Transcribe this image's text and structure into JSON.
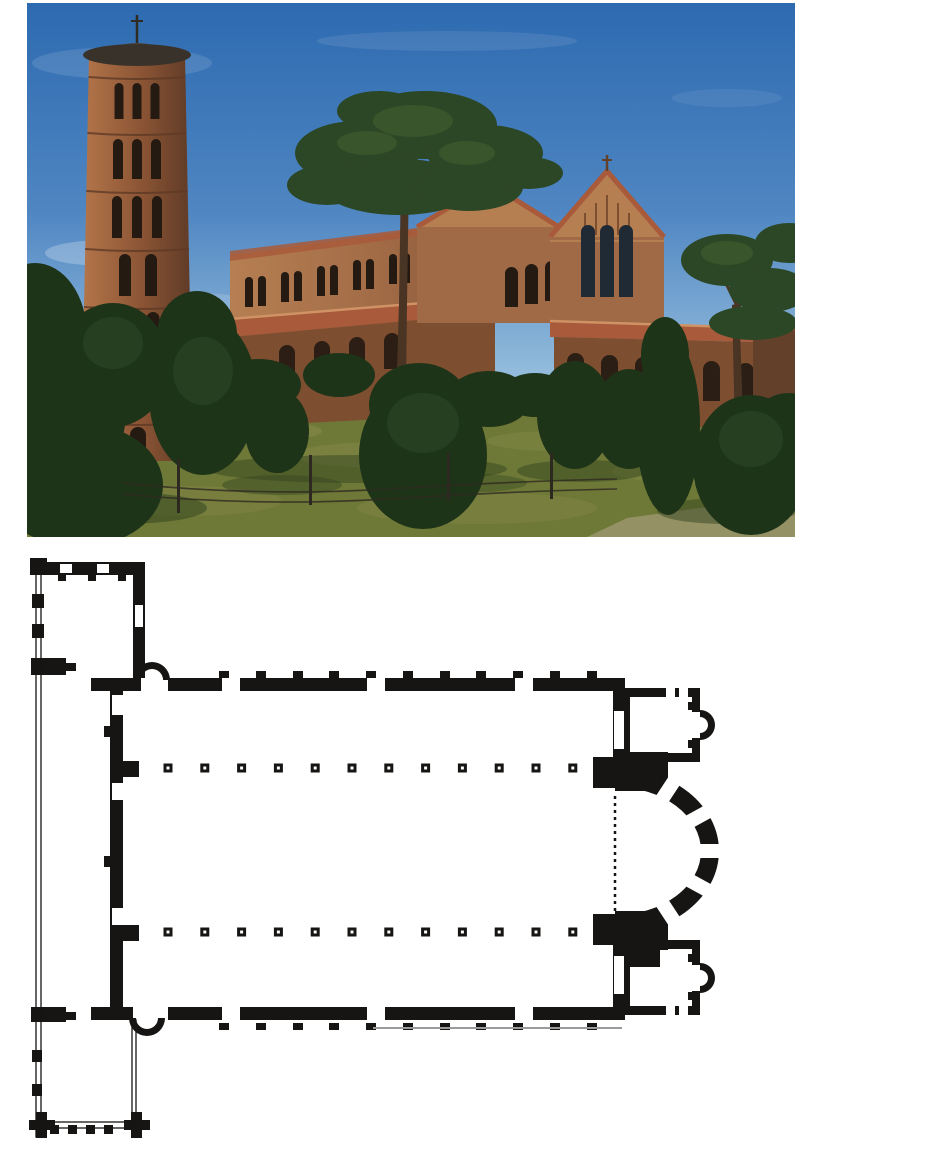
{
  "figure": {
    "photo_label": "Exterior photograph: brick basilica with round campanile among pines",
    "plan_label": "Floor plan: narthex with corner rooms, nave with twin colonnades of 12 columns, apse flanked by two chapels with small apses"
  },
  "palette": {
    "paper": "#ffffff",
    "ink": "#171513",
    "sky_top": "#2d6ab0",
    "sky_mid": "#4f86c2",
    "sky_low": "#96bedd",
    "cloud": "#e8f0f7",
    "grass": "#6e7837",
    "grass_light": "#8d8f4e",
    "grass_dark": "#33451f",
    "path": "#98946a",
    "brick": "#a06a46",
    "brick_lit": "#b67f52",
    "brick_shade": "#7e4e31",
    "brick_dark": "#63402a",
    "roof": "#a85a3a",
    "roof_lit": "#cf9264",
    "opening": "#241a12",
    "glass": "#202a35",
    "tower_lit": "#b5764a",
    "tower_mid": "#8a5434",
    "tower_shade": "#5e3a26",
    "cap": "#38322a",
    "tree": "#2c4726",
    "tree_light": "#46632f",
    "tree_dark": "#1e3418",
    "trunk": "#4a3424",
    "wall_white": "#e3dfd0",
    "fence": "#2e2920"
  },
  "photo": {
    "clouds": [
      [
        95,
        60,
        90,
        16,
        0.13
      ],
      [
        420,
        38,
        130,
        10,
        0.1
      ],
      [
        80,
        250,
        62,
        13,
        0.28
      ],
      [
        160,
        300,
        70,
        10,
        0.18
      ],
      [
        700,
        95,
        55,
        9,
        0.08
      ]
    ],
    "grass_patches": [
      [
        210,
        428,
        85,
        12,
        0.45
      ],
      [
        360,
        452,
        95,
        13,
        0.4
      ],
      [
        530,
        438,
        70,
        10,
        0.35
      ],
      [
        660,
        468,
        75,
        12,
        0.35
      ],
      [
        160,
        498,
        95,
        15,
        0.3
      ],
      [
        450,
        505,
        120,
        16,
        0.3
      ]
    ],
    "grass_shadows": [
      [
        330,
        466,
        150,
        14,
        0.5
      ],
      [
        95,
        505,
        85,
        16,
        0.55
      ],
      [
        555,
        468,
        65,
        11,
        0.5
      ],
      [
        700,
        508,
        70,
        13,
        0.5
      ],
      [
        255,
        482,
        60,
        10,
        0.45
      ],
      [
        430,
        480,
        70,
        10,
        0.4
      ]
    ],
    "tower": {
      "belts": [
        74,
        130,
        188,
        246,
        304,
        362,
        420
      ],
      "tiers": [
        {
          "y": 80,
          "h": 36,
          "w": 9,
          "xs": [
            92,
            110,
            128
          ]
        },
        {
          "y": 136,
          "h": 40,
          "w": 10,
          "xs": [
            91,
            110,
            129
          ]
        },
        {
          "y": 193,
          "h": 42,
          "w": 10,
          "xs": [
            90,
            110,
            130
          ]
        },
        {
          "y": 251,
          "h": 42,
          "w": 12,
          "xs": [
            98,
            124
          ]
        },
        {
          "y": 309,
          "h": 44,
          "w": 13,
          "xs": [
            96,
            126
          ]
        },
        {
          "y": 367,
          "h": 44,
          "w": 16,
          "xs": [
            111
          ]
        },
        {
          "y": 424,
          "h": 28,
          "w": 16,
          "xs": [
            111
          ]
        }
      ]
    },
    "flank_windows": [
      [
        218,
        274
      ],
      [
        254,
        269
      ],
      [
        290,
        263
      ],
      [
        326,
        257
      ],
      [
        362,
        251
      ],
      [
        398,
        246
      ]
    ],
    "flank_window": {
      "w": 8,
      "h": 30,
      "gap": 13
    },
    "flank_arcade": [
      [
        252,
        342
      ],
      [
        287,
        338
      ],
      [
        322,
        334
      ],
      [
        357,
        330
      ]
    ],
    "midblock_windows": [
      [
        478,
        264
      ],
      [
        498,
        261
      ],
      [
        518,
        258
      ]
    ],
    "facade_windows": [
      [
        554,
        222
      ],
      [
        573,
        222
      ],
      [
        592,
        222
      ]
    ],
    "gable_strips": [
      [
        558,
        210
      ],
      [
        569,
        200
      ],
      [
        580,
        192
      ],
      [
        591,
        200
      ],
      [
        602,
        210
      ]
    ],
    "porch_arches": [
      [
        540,
        350
      ],
      [
        574,
        352
      ],
      [
        608,
        354
      ],
      [
        642,
        356
      ],
      [
        676,
        358
      ],
      [
        710,
        360
      ]
    ],
    "wall_posts": [
      112,
      147,
      182,
      217,
      252,
      287,
      322,
      357,
      392
    ],
    "fence_posts": [
      [
        150,
        456,
        54
      ],
      [
        282,
        452,
        50
      ],
      [
        420,
        450,
        48
      ],
      [
        523,
        450,
        46
      ]
    ],
    "fence_wires": [
      "M95,480 Q230,494 360,486 T590,476",
      "M95,491 Q230,504 360,496 T590,486"
    ],
    "pines": [
      [
        330,
        150,
        62,
        32
      ],
      [
        398,
        122,
        72,
        34
      ],
      [
        458,
        150,
        58,
        28
      ],
      [
        372,
        184,
        76,
        28
      ],
      [
        442,
        184,
        54,
        24
      ],
      [
        300,
        182,
        40,
        20
      ],
      [
        502,
        170,
        34,
        16
      ],
      [
        352,
        108,
        42,
        20
      ],
      [
        700,
        257,
        46,
        26
      ],
      [
        742,
        287,
        40,
        22
      ],
      [
        762,
        240,
        34,
        20
      ],
      [
        726,
        320,
        44,
        17
      ]
    ],
    "pine_highlights": [
      [
        386,
        118,
        40,
        16
      ],
      [
        340,
        140,
        30,
        12
      ],
      [
        440,
        150,
        28,
        12
      ],
      [
        700,
        250,
        26,
        12
      ]
    ],
    "bushes": [
      [
        28,
        400,
        72,
        98
      ],
      [
        86,
        362,
        56,
        62
      ],
      [
        52,
        482,
        84,
        62
      ],
      [
        8,
        332,
        52,
        72
      ],
      [
        176,
        392,
        54,
        80
      ],
      [
        170,
        332,
        40,
        44
      ],
      [
        250,
        428,
        32,
        42
      ],
      [
        396,
        452,
        64,
        74
      ],
      [
        392,
        402,
        50,
        42
      ],
      [
        548,
        412,
        38,
        54
      ],
      [
        602,
        416,
        36,
        50
      ],
      [
        641,
        422,
        32,
        90
      ],
      [
        638,
        352,
        24,
        38
      ],
      [
        724,
        462,
        58,
        70
      ],
      [
        762,
        432,
        42,
        42
      ],
      [
        462,
        396,
        42,
        28
      ],
      [
        508,
        392,
        34,
        22
      ],
      [
        312,
        372,
        36,
        22
      ],
      [
        232,
        382,
        42,
        26
      ]
    ],
    "bush_highlights": [
      [
        176,
        368,
        30,
        34
      ],
      [
        396,
        420,
        36,
        30
      ],
      [
        86,
        340,
        30,
        26
      ],
      [
        724,
        436,
        32,
        28
      ]
    ],
    "trunks": [
      "M367,470 L372,300 374,172 382,172 380,300 378,470 Z",
      "M709,470 L705,302 712,300 718,468 Z",
      "M249,470 L251,400 255,400 256,470 Z"
    ],
    "branches": [
      "M376,178 L344,132",
      "M376,178 L404,128",
      "M377,184 L432,152",
      "M377,184 L322,160",
      "M711,305 L690,262",
      "M711,305 L736,268"
    ]
  },
  "plan": {
    "black_rects": [
      [
        7,
        6,
        110,
        13
      ],
      [
        105,
        6,
        12,
        129
      ],
      [
        2,
        2,
        17,
        17
      ],
      [
        4,
        38,
        12,
        14
      ],
      [
        4,
        68,
        12,
        14
      ],
      [
        30,
        19,
        8,
        6
      ],
      [
        60,
        19,
        8,
        6
      ],
      [
        90,
        19,
        8,
        6
      ],
      [
        3,
        102,
        35,
        17
      ],
      [
        38,
        107,
        10,
        8
      ],
      [
        63,
        122,
        42,
        13
      ],
      [
        140,
        122,
        457,
        13
      ],
      [
        191,
        115,
        10,
        7
      ],
      [
        228,
        115,
        10,
        7
      ],
      [
        265,
        115,
        10,
        7
      ],
      [
        301,
        115,
        10,
        7
      ],
      [
        338,
        115,
        10,
        7
      ],
      [
        375,
        115,
        10,
        7
      ],
      [
        412,
        115,
        10,
        7
      ],
      [
        448,
        115,
        10,
        7
      ],
      [
        485,
        115,
        10,
        7
      ],
      [
        522,
        115,
        10,
        7
      ],
      [
        559,
        115,
        10,
        7
      ],
      [
        82,
        122,
        13,
        342
      ],
      [
        95,
        205,
        16,
        16
      ],
      [
        95,
        369,
        16,
        16
      ],
      [
        76,
        170,
        6,
        11
      ],
      [
        76,
        300,
        6,
        11
      ],
      [
        3,
        451,
        35,
        15
      ],
      [
        38,
        456,
        10,
        8
      ],
      [
        63,
        451,
        42,
        13
      ],
      [
        140,
        451,
        457,
        13
      ],
      [
        191,
        467,
        10,
        7
      ],
      [
        228,
        467,
        10,
        7
      ],
      [
        265,
        467,
        10,
        7
      ],
      [
        301,
        467,
        10,
        7
      ],
      [
        338,
        467,
        10,
        7
      ],
      [
        375,
        467,
        10,
        7
      ],
      [
        412,
        467,
        10,
        7
      ],
      [
        448,
        467,
        10,
        7
      ],
      [
        485,
        467,
        10,
        7
      ],
      [
        522,
        467,
        10,
        7
      ],
      [
        559,
        467,
        10,
        7
      ],
      [
        585,
        122,
        12,
        83
      ],
      [
        565,
        201,
        38,
        31
      ],
      [
        587,
        196,
        53,
        39
      ],
      [
        565,
        358,
        38,
        31
      ],
      [
        587,
        355,
        53,
        39
      ],
      [
        585,
        385,
        12,
        79
      ],
      [
        594,
        132,
        78,
        9
      ],
      [
        594,
        132,
        8,
        74
      ],
      [
        664,
        132,
        8,
        74
      ],
      [
        594,
        197,
        78,
        9
      ],
      [
        660,
        146,
        12,
        8
      ],
      [
        660,
        184,
        12,
        8
      ],
      [
        600,
        197,
        32,
        27
      ],
      [
        594,
        384,
        78,
        9
      ],
      [
        594,
        384,
        8,
        75
      ],
      [
        664,
        384,
        8,
        75
      ],
      [
        594,
        450,
        78,
        9
      ],
      [
        660,
        398,
        12,
        8
      ],
      [
        660,
        436,
        12,
        8
      ],
      [
        600,
        387,
        32,
        24
      ],
      [
        22,
        569,
        9,
        9
      ],
      [
        40,
        569,
        9,
        9
      ],
      [
        58,
        569,
        9,
        9
      ],
      [
        76,
        569,
        9,
        9
      ],
      [
        1,
        564,
        26,
        10
      ],
      [
        8,
        556,
        11,
        26
      ],
      [
        96,
        564,
        26,
        10
      ],
      [
        103,
        556,
        11,
        26
      ],
      [
        4,
        494,
        10,
        12
      ],
      [
        4,
        528,
        10,
        12
      ]
    ],
    "white_rects": [
      [
        32,
        8,
        12,
        9
      ],
      [
        69,
        8,
        12,
        9
      ],
      [
        107,
        49,
        8,
        22
      ],
      [
        194,
        122,
        18,
        13
      ],
      [
        339,
        122,
        18,
        13
      ],
      [
        487,
        122,
        18,
        13
      ],
      [
        84,
        139,
        11,
        20
      ],
      [
        84,
        227,
        11,
        17
      ],
      [
        84,
        352,
        11,
        17
      ],
      [
        194,
        451,
        18,
        13
      ],
      [
        339,
        451,
        18,
        13
      ],
      [
        487,
        451,
        18,
        13
      ],
      [
        586,
        155,
        10,
        38
      ],
      [
        586,
        400,
        10,
        38
      ],
      [
        638,
        132,
        9,
        9
      ],
      [
        651,
        132,
        9,
        9
      ],
      [
        664,
        156,
        8,
        26
      ],
      [
        638,
        450,
        9,
        9
      ],
      [
        651,
        450,
        9,
        9
      ],
      [
        664,
        409,
        8,
        26
      ],
      [
        113,
        122,
        22,
        13
      ],
      [
        108,
        451,
        22,
        11
      ]
    ],
    "stroke_rects": [
      [
        8,
        6,
        5,
        575
      ],
      [
        104,
        464,
        4,
        102
      ],
      [
        8,
        566,
        98,
        6
      ]
    ],
    "gray_line": [
      345,
      472,
      594,
      472
    ],
    "columns": {
      "rows": [
        212,
        376
      ],
      "start_x": 140,
      "spacing": 36.8,
      "count": 12,
      "size": 9,
      "dot": 3
    },
    "apse": {
      "cx": 587,
      "cy": 295,
      "rx_out": 104,
      "ry_out": 83,
      "rx_in": 86,
      "ry_in": 64,
      "window_angles": [
        -56,
        -28,
        0,
        28,
        56
      ],
      "window_width": 14
    },
    "side_apses": [
      {
        "cx": 672,
        "cy": 169,
        "r_out": 15,
        "r_in": 8
      },
      {
        "cx": 672,
        "cy": 422,
        "r_out": 15,
        "r_in": 8
      }
    ],
    "niches": [
      {
        "cx": 124,
        "base_y": 124,
        "r_out": 18,
        "r_in": 11,
        "dir": "up"
      },
      {
        "cx": 119,
        "base_y": 462,
        "r_out": 18,
        "r_in": 11,
        "dir": "down"
      }
    ],
    "dotted_line": {
      "x": 587,
      "y1": 240,
      "y2": 356
    }
  }
}
